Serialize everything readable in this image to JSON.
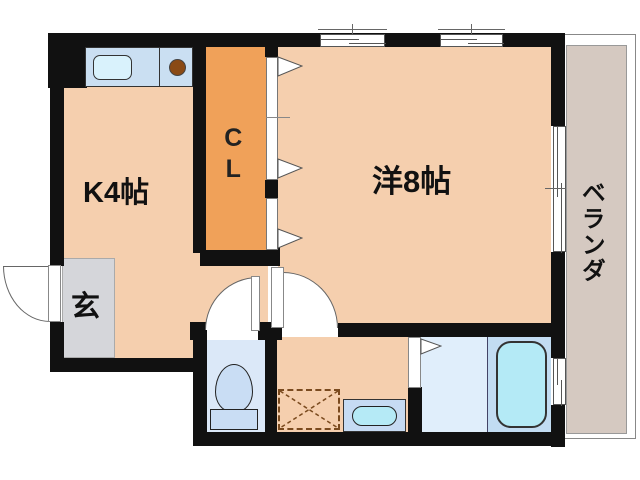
{
  "rooms": {
    "kitchen": {
      "label": "K4帖"
    },
    "western_room": {
      "label": "洋8帖"
    },
    "closet": {
      "label": "CL"
    },
    "entrance": {
      "label": "玄"
    },
    "veranda": {
      "label": "ベランダ"
    }
  },
  "fixtures": {
    "kitchen_sink": "kitchen-sink-icon",
    "stove_burner": "stove-burner-icon",
    "toilet": "toilet-icon",
    "washing_machine_space": "washing-machine-space-icon",
    "wash_basin": "wash-basin-icon",
    "bathtub": "bathtub-icon",
    "entry_door": "entry-door-swing-icon",
    "toilet_door": "door-swing-icon",
    "washroom_door": "door-swing-icon",
    "closet_folding_door": "folding-door-icon",
    "bath_folding_door": "folding-door-icon",
    "windows": "sliding-window-icon"
  },
  "colors": {
    "wall": "#111111",
    "floor_peach": "#f5cfae",
    "closet_orange": "#f0a159",
    "entrance_gray": "#d5d6da",
    "counter_blue": "#cadff2",
    "wet_room_blue": "#dbe8f8",
    "fixture_blue": "#c9ddf4",
    "water_cyan": "#b5eaf6",
    "bath_floor": "#e0eefb",
    "tub_zone": "#c2dcf2",
    "veranda_gray": "#d5c9c1"
  }
}
